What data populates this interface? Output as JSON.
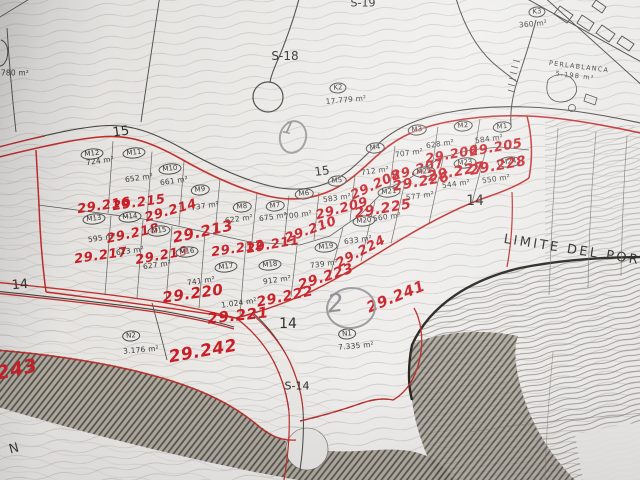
{
  "colors": {
    "paper": "#e7e5e2",
    "ink": "#3a3833",
    "contour": "#a9a49d",
    "red": "#c81e26",
    "pencil": "#8e8d90"
  },
  "plots": [
    {
      "id": "M1",
      "area": "584 m²",
      "parcel": "29.205",
      "cx": 502,
      "cy": 127,
      "ax": 489,
      "ay": 139,
      "rx": 496,
      "ry": 148,
      "rrot": -10,
      "rsize": 13
    },
    {
      "id": "M2",
      "area": "628 m²",
      "parcel": "29.206",
      "cx": 463,
      "cy": 126,
      "ax": 440,
      "ay": 144,
      "rx": 452,
      "ry": 155,
      "rrot": -10,
      "rsize": 13
    },
    {
      "id": "M3",
      "area": "707 m²",
      "parcel": "29.207",
      "cx": 417,
      "cy": 130,
      "ax": 409,
      "ay": 153,
      "rx": 418,
      "ry": 170,
      "rrot": -15,
      "rsize": 13
    },
    {
      "id": "M4",
      "area": "712 m²",
      "parcel": "29.208",
      "cx": 375,
      "cy": 148,
      "ax": 375,
      "ay": 171,
      "rx": 376,
      "ry": 185,
      "rrot": -25,
      "rsize": 13
    },
    {
      "id": "M5",
      "area": "583 m²",
      "parcel": "29.209",
      "cx": 337,
      "cy": 181,
      "ax": 337,
      "ay": 198,
      "rx": 342,
      "ry": 209,
      "rrot": -15,
      "rsize": 13
    },
    {
      "id": "M6",
      "area": "700 m²",
      "parcel": "29.210",
      "cx": 304,
      "cy": 194,
      "ax": 298,
      "ay": 215,
      "rx": 311,
      "ry": 230,
      "rrot": -20,
      "rsize": 13
    },
    {
      "id": "M7",
      "area": "675 m²",
      "parcel": "29.211",
      "cx": 275,
      "cy": 206,
      "ax": 273,
      "ay": 217,
      "rx": 273,
      "ry": 245,
      "rrot": -10,
      "rsize": 13
    },
    {
      "id": "M8",
      "area": "622 m²",
      "parcel": "29.212",
      "cx": 242,
      "cy": 207,
      "ax": 239,
      "ay": 219,
      "rx": 238,
      "ry": 249,
      "rrot": -8,
      "rsize": 13
    },
    {
      "id": "M9",
      "area": "737 m²",
      "parcel": "29.213",
      "cx": 200,
      "cy": 190,
      "ax": 205,
      "ay": 206,
      "rx": 203,
      "ry": 232,
      "rrot": -12,
      "rsize": 15
    },
    {
      "id": "M10",
      "area": "661 m²",
      "parcel": "29.214",
      "cx": 170,
      "cy": 169,
      "ax": 174,
      "ay": 181,
      "rx": 171,
      "ry": 211,
      "rrot": -16,
      "rsize": 13
    },
    {
      "id": "M11",
      "area": "652 m²",
      "parcel": "29.215",
      "cx": 134,
      "cy": 153,
      "ax": 139,
      "ay": 178,
      "rx": 139,
      "ry": 203,
      "rrot": -8,
      "rsize": 13
    },
    {
      "id": "M12",
      "area": "724 m²",
      "parcel": "29.216",
      "cx": 92,
      "cy": 154,
      "ax": 100,
      "ay": 161,
      "rx": 104,
      "ry": 206,
      "rrot": -8,
      "rsize": 13
    },
    {
      "id": "M13",
      "area": "595 m²",
      "parcel": "29.217",
      "cx": 94,
      "cy": 219,
      "ax": 102,
      "ay": 238,
      "rx": 101,
      "ry": 256,
      "rrot": -8,
      "rsize": 13
    },
    {
      "id": "M14",
      "area": "613 m²",
      "parcel": "29.218",
      "cx": 130,
      "cy": 217,
      "ax": 130,
      "ay": 251,
      "rx": 133,
      "ry": 234,
      "rrot": -12,
      "rsize": 13
    },
    {
      "id": "M15",
      "area": "627 m²",
      "parcel": "29.219",
      "cx": 159,
      "cy": 231,
      "ax": 157,
      "ay": 265,
      "rx": 162,
      "ry": 256,
      "rrot": -10,
      "rsize": 13
    },
    {
      "id": "M16",
      "area": "741 m²",
      "parcel": "29.220",
      "cx": 187,
      "cy": 252,
      "ax": 201,
      "ay": 281,
      "rx": 193,
      "ry": 294,
      "rrot": -8,
      "rsize": 15
    },
    {
      "id": "M17",
      "area": "1.024 m²",
      "parcel": "29.221",
      "cx": 226,
      "cy": 267,
      "ax": 239,
      "ay": 303,
      "rx": 238,
      "ry": 316,
      "rrot": -6,
      "rsize": 15
    },
    {
      "id": "M18",
      "area": "912 m²",
      "parcel": "29.222",
      "cx": 270,
      "cy": 265,
      "ax": 277,
      "ay": 280,
      "rx": 285,
      "ry": 297,
      "rrot": -12,
      "rsize": 14
    },
    {
      "id": "M19",
      "area": "739 m²",
      "parcel": "29.223",
      "cx": 326,
      "cy": 247,
      "ax": 324,
      "ay": 264,
      "rx": 326,
      "ry": 277,
      "rrot": -18,
      "rsize": 14
    },
    {
      "id": "M20",
      "area": "633 m²",
      "parcel": "29.224",
      "cx": 364,
      "cy": 221,
      "ax": 358,
      "ay": 240,
      "rx": 361,
      "ry": 252,
      "rrot": -28,
      "rsize": 13
    },
    {
      "id": "M21",
      "area": "560 m²",
      "parcel": "29.225",
      "cx": 389,
      "cy": 192,
      "ax": 387,
      "ay": 217,
      "rx": 383,
      "ry": 209,
      "rrot": -10,
      "rsize": 14
    },
    {
      "id": "M22",
      "area": "577 m²",
      "parcel": "29.226",
      "cx": 424,
      "cy": 172,
      "ax": 420,
      "ay": 196,
      "rx": 421,
      "ry": 182,
      "rrot": -10,
      "rsize": 14
    },
    {
      "id": "M23",
      "area": "544 m²",
      "parcel": "29.227",
      "cx": 465,
      "cy": 163,
      "ax": 456,
      "ay": 184,
      "rx": 456,
      "ry": 172,
      "rrot": -10,
      "rsize": 14
    },
    {
      "id": "M24",
      "area": "550 m²",
      "parcel": "29.228",
      "cx": 509,
      "cy": 162,
      "ax": 496,
      "ay": 179,
      "rx": 498,
      "ry": 166,
      "rrot": -10,
      "rsize": 14
    }
  ],
  "landmarks": [
    {
      "id": "K2",
      "area": "17.779 m²",
      "cx": 338,
      "cy": 88,
      "ax": 346,
      "ay": 100
    },
    {
      "id": "K3",
      "area": "360 m²",
      "cx": 537,
      "cy": 12,
      "ax": 533,
      "ay": 24
    },
    {
      "id": "N1",
      "area": "7.335 m²",
      "cx": 347,
      "cy": 334,
      "ax": 356,
      "ay": 346
    },
    {
      "id": "N2",
      "area": "3.176 m²",
      "cx": 131,
      "cy": 336,
      "ax": 141,
      "ay": 350
    }
  ],
  "free_areas": [
    {
      "text": "780 m²",
      "x": 15,
      "y": 73,
      "rot": 0
    }
  ],
  "red_notes": [
    {
      "text": "29.241",
      "x": 396,
      "y": 297,
      "rot": -22,
      "size": 15
    },
    {
      "text": "29.242",
      "x": 203,
      "y": 352,
      "rot": -10,
      "size": 17
    },
    {
      "text": "243",
      "x": 17,
      "y": 370,
      "rot": -12,
      "size": 19
    }
  ],
  "pencil_notes": [
    {
      "text": "1",
      "x": 293,
      "y": 137,
      "w": 24,
      "h": 30,
      "rot": 14,
      "size": 17
    },
    {
      "text": "2",
      "x": 351,
      "y": 308,
      "w": 46,
      "h": 38,
      "rot": -6,
      "size": 25
    }
  ],
  "road_labels": [
    {
      "text": "15",
      "x": 121,
      "y": 132,
      "rot": -8,
      "size": 13
    },
    {
      "text": "15",
      "x": 322,
      "y": 171,
      "rot": -8,
      "size": 12
    },
    {
      "text": "14",
      "x": 20,
      "y": 285,
      "rot": -5,
      "size": 13
    },
    {
      "text": "14",
      "x": 288,
      "y": 324,
      "rot": 0,
      "size": 14
    },
    {
      "text": "14",
      "x": 475,
      "y": 201,
      "rot": 0,
      "size": 14
    },
    {
      "text": "S-14",
      "x": 297,
      "y": 386,
      "rot": 0,
      "size": 11
    },
    {
      "text": "S-18",
      "x": 285,
      "y": 56,
      "rot": 0,
      "size": 12
    },
    {
      "text": "S-19",
      "x": 363,
      "y": 3,
      "rot": 0,
      "size": 11
    }
  ],
  "boundary_label": {
    "text": "LIMITE DEL PORN",
    "x": 578,
    "y": 251,
    "rot": 9,
    "size": 13
  },
  "place_label": {
    "name": "PERLABLANCA",
    "area": "5.198 m²",
    "x": 579,
    "y": 67,
    "ax": 575,
    "ay": 76,
    "rot": 7
  },
  "edge_letter": {
    "text": "N",
    "x": 14,
    "y": 449,
    "rot": -15,
    "size": 13
  }
}
